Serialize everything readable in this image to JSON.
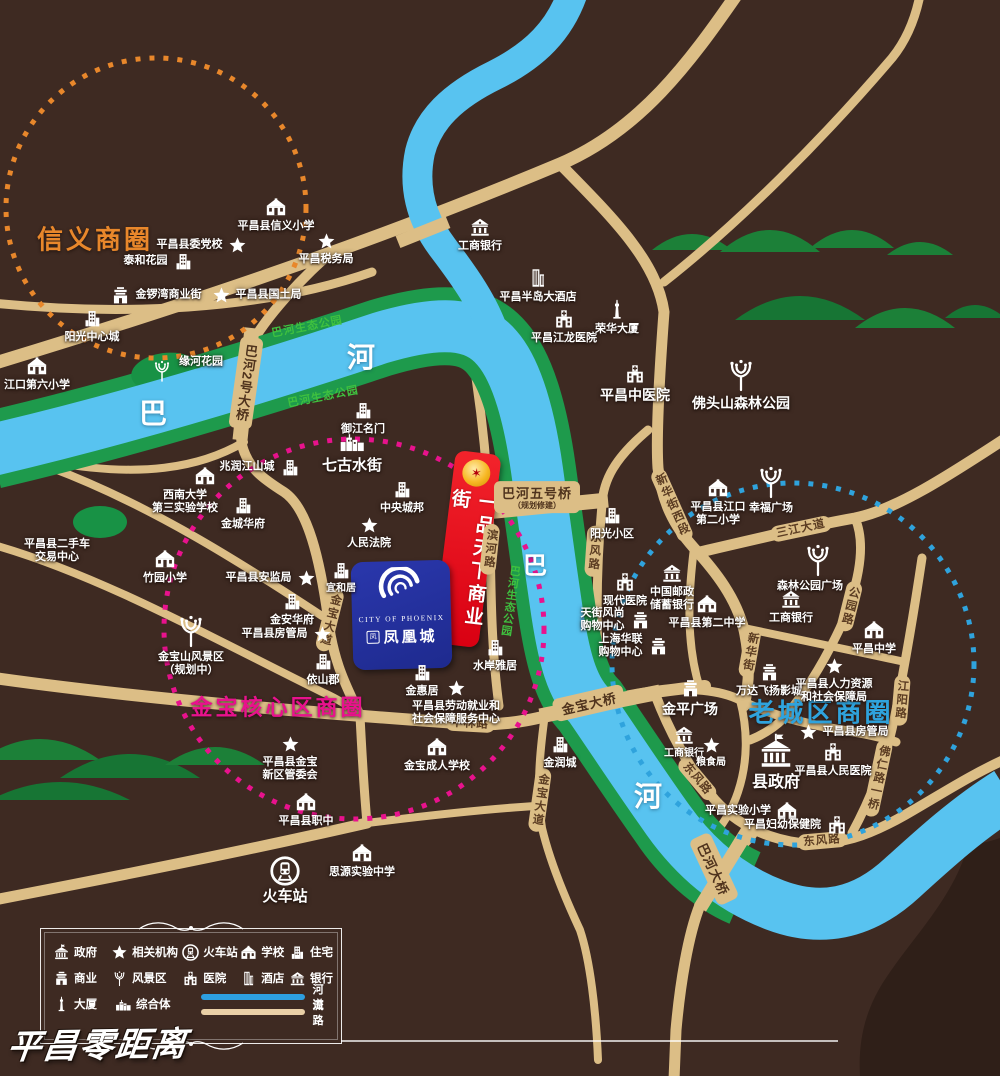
{
  "watermark": "平昌零距离",
  "zones": [
    {
      "label": "信义商圈",
      "color": "#E8872B",
      "cx": 156,
      "cy": 208,
      "r": 150,
      "lx": 95,
      "ly": 238,
      "fs": 26
    },
    {
      "label": "金宝核心区商圈",
      "color": "#E8128D",
      "cx": 354,
      "cy": 629,
      "r": 190,
      "lx": 278,
      "ly": 706,
      "fs": 22
    },
    {
      "label": "老城区商圈",
      "color": "#2FA3DD",
      "cx": 793,
      "cy": 664,
      "r": 181,
      "lx": 821,
      "ly": 711,
      "fs": 26
    }
  ],
  "river_labels": [
    {
      "t": "巴",
      "x": 153,
      "y": 412,
      "fs": 28
    },
    {
      "t": "河",
      "x": 361,
      "y": 356,
      "fs": 28
    },
    {
      "t": "巴",
      "x": 535,
      "y": 563,
      "fs": 24
    },
    {
      "t": "河",
      "x": 648,
      "y": 795,
      "fs": 28
    }
  ],
  "park_labels": [
    {
      "t": "巴河生态公园",
      "x": 307,
      "y": 326,
      "rot": -11
    },
    {
      "t": "巴河生态公园",
      "x": 323,
      "y": 396,
      "rot": -11
    },
    {
      "t": "巴河生态公园",
      "x": 510,
      "y": 601,
      "vert": 1,
      "rot": 8
    }
  ],
  "bridge_labels": [
    {
      "t": "巴河2号大桥",
      "x": 246,
      "y": 383,
      "vert": 1,
      "rot": 8
    },
    {
      "t": "巴河五号桥",
      "sub": "（规划修建）",
      "x": 537,
      "y": 497,
      "rot": 0
    },
    {
      "t": "金宝大桥",
      "x": 589,
      "y": 703,
      "rot": -13
    },
    {
      "t": "巴河大桥",
      "x": 714,
      "y": 869,
      "rot": 65
    }
  ],
  "road_labels": [
    {
      "t": "滨河路",
      "x": 490,
      "y": 549,
      "vert": 1,
      "rot": 6
    },
    {
      "t": "东风路",
      "x": 594,
      "y": 551,
      "vert": 1,
      "rot": 4
    },
    {
      "t": "东风路",
      "x": 697,
      "y": 779,
      "rot": 50
    },
    {
      "t": "东风路",
      "x": 822,
      "y": 841,
      "rot": -5
    },
    {
      "t": "新华街西段",
      "x": 672,
      "y": 505,
      "vert": 1,
      "rot": -24
    },
    {
      "t": "三江大道",
      "x": 801,
      "y": 529,
      "rot": -12
    },
    {
      "t": "公园路",
      "x": 850,
      "y": 606,
      "vert": 1,
      "rot": 14
    },
    {
      "t": "新华街",
      "x": 750,
      "y": 652,
      "vert": 1,
      "rot": 10
    },
    {
      "t": "江阳路",
      "x": 901,
      "y": 700,
      "vert": 1,
      "rot": 5
    },
    {
      "t": "佛仁路一桥",
      "x": 878,
      "y": 778,
      "vert": 1,
      "rot": 12
    },
    {
      "t": "金宝大道",
      "x": 330,
      "y": 620,
      "vert": 1,
      "rot": 14
    },
    {
      "t": "金宝大道",
      "x": 540,
      "y": 800,
      "vert": 1,
      "rot": 8
    },
    {
      "t": "中林路",
      "x": 470,
      "y": 724,
      "rot": 3
    }
  ],
  "pois": [
    {
      "t": "school",
      "x": 276,
      "y": 207,
      "lp": "b",
      "l": [
        "平昌县信义小学"
      ]
    },
    {
      "t": "star",
      "x": 237,
      "y": 245,
      "lp": "l",
      "l": [
        "平昌县委党校"
      ]
    },
    {
      "t": "star",
      "x": 326,
      "y": 241,
      "lp": "b",
      "l": [
        "平昌税务局"
      ]
    },
    {
      "t": "residence",
      "x": 183,
      "y": 261,
      "lp": "l",
      "l": [
        "泰和花园"
      ]
    },
    {
      "t": "commerce",
      "x": 120,
      "y": 295,
      "lp": "r",
      "l": [
        "金锣湾商业街"
      ]
    },
    {
      "t": "star",
      "x": 221,
      "y": 295,
      "lp": "r",
      "l": [
        "平昌县国土局"
      ]
    },
    {
      "t": "residence",
      "x": 92,
      "y": 318,
      "lp": "b",
      "l": [
        "阳光中心城"
      ]
    },
    {
      "t": "school",
      "x": 37,
      "y": 366,
      "lp": "b",
      "l": [
        "江口第六小学"
      ]
    },
    {
      "t": "bank",
      "x": 480,
      "y": 227,
      "lp": "b",
      "l": [
        "工商银行"
      ]
    },
    {
      "t": "hotel",
      "x": 538,
      "y": 278,
      "lp": "b",
      "l": [
        "平昌半岛大酒店"
      ]
    },
    {
      "t": "hospital",
      "x": 564,
      "y": 319,
      "lp": "b",
      "l": [
        "平昌江龙医院"
      ]
    },
    {
      "t": "tower",
      "x": 617,
      "y": 310,
      "lp": "b",
      "l": [
        "荣华大厦"
      ]
    },
    {
      "t": "hospital",
      "x": 635,
      "y": 374,
      "lp": "b",
      "l": [
        "平昌中医院"
      ],
      "fs": 14
    },
    {
      "t": "tree",
      "x": 741,
      "y": 375,
      "lp": "b",
      "l": [
        "佛头山森林公园"
      ],
      "fs": 14,
      "big": 1
    },
    {
      "t": "tree",
      "x": 162,
      "y": 371,
      "lp": "r",
      "l": [
        "缘河花园"
      ],
      "dy": -9
    },
    {
      "t": "residence",
      "x": 363,
      "y": 410,
      "lp": "b",
      "l": [
        "御江名门"
      ]
    },
    {
      "t": "complex",
      "x": 352,
      "y": 441,
      "lp": "b",
      "l": [
        "七古水街"
      ],
      "fs": 15
    },
    {
      "t": "residence",
      "x": 290,
      "y": 467,
      "lp": "l",
      "l": [
        "兆润江山城"
      ]
    },
    {
      "t": "school",
      "x": 205,
      "y": 476,
      "lp": "b",
      "l": [
        "西南大学",
        "第三实验学校"
      ],
      "dx": -20
    },
    {
      "t": "none",
      "x": 57,
      "y": 551,
      "lp": "c",
      "l": [
        "平昌县二手车",
        "交易中心"
      ]
    },
    {
      "t": "residence",
      "x": 243,
      "y": 505,
      "lp": "b",
      "l": [
        "金城华府"
      ]
    },
    {
      "t": "residence",
      "x": 402,
      "y": 489,
      "lp": "b",
      "l": [
        "中央城邦"
      ]
    },
    {
      "t": "star",
      "x": 369,
      "y": 525,
      "lp": "b",
      "l": [
        "人民法院"
      ]
    },
    {
      "t": "school",
      "x": 165,
      "y": 559,
      "lp": "b",
      "l": [
        "竹园小学"
      ]
    },
    {
      "t": "star",
      "x": 306,
      "y": 578,
      "lp": "l",
      "l": [
        "平昌县安监局"
      ]
    },
    {
      "t": "residence",
      "x": 341,
      "y": 570,
      "lp": "b",
      "l": [
        "宜和居"
      ],
      "fs": 10
    },
    {
      "t": "residence",
      "x": 292,
      "y": 601,
      "lp": "b",
      "l": [
        "金安华府"
      ]
    },
    {
      "t": "star",
      "x": 322,
      "y": 634,
      "lp": "l",
      "l": [
        "平昌县房管局"
      ]
    },
    {
      "t": "residence",
      "x": 323,
      "y": 661,
      "lp": "b",
      "l": [
        "依山郡"
      ]
    },
    {
      "t": "tree",
      "x": 191,
      "y": 631,
      "lp": "b",
      "l": [
        "金宝山风景区",
        "（规划中）"
      ],
      "big": 1
    },
    {
      "t": "residence",
      "x": 612,
      "y": 515,
      "lp": "b",
      "l": [
        "阳光小区"
      ]
    },
    {
      "t": "hospital",
      "x": 625,
      "y": 582,
      "lp": "b",
      "l": [
        "现代医院"
      ]
    },
    {
      "t": "bank",
      "x": 672,
      "y": 573,
      "lp": "b",
      "l": [
        "中国邮政",
        "储蓄银行"
      ]
    },
    {
      "t": "school",
      "x": 707,
      "y": 604,
      "lp": "b",
      "l": [
        "平昌县第二中学"
      ]
    },
    {
      "t": "commerce",
      "x": 640,
      "y": 620,
      "lp": "l",
      "l": [
        "天街风尚",
        "购物中心"
      ]
    },
    {
      "t": "commerce",
      "x": 658,
      "y": 646,
      "lp": "l",
      "l": [
        "上海华联",
        "购物中心"
      ]
    },
    {
      "t": "school",
      "x": 718,
      "y": 488,
      "lp": "b",
      "l": [
        "平昌县江口",
        "第二小学"
      ]
    },
    {
      "t": "tree",
      "x": 771,
      "y": 482,
      "lp": "b",
      "l": [
        "幸福广场"
      ],
      "big": 1
    },
    {
      "t": "tree",
      "x": 818,
      "y": 560,
      "lp": "b",
      "l": [
        "森林公园广场"
      ],
      "big": 1,
      "dx": -8
    },
    {
      "t": "bank",
      "x": 791,
      "y": 599,
      "lp": "b",
      "l": [
        "工商银行"
      ]
    },
    {
      "t": "school",
      "x": 874,
      "y": 630,
      "lp": "b",
      "l": [
        "平昌中学"
      ]
    },
    {
      "t": "commerce",
      "x": 769,
      "y": 672,
      "lp": "b",
      "l": [
        "万达飞扬影城"
      ]
    },
    {
      "t": "star",
      "x": 834,
      "y": 666,
      "lp": "b",
      "l": [
        "平昌县人力资源",
        "和社会保障局"
      ]
    },
    {
      "t": "commerce",
      "x": 690,
      "y": 688,
      "lp": "b",
      "l": [
        "金平广场"
      ],
      "fs": 14
    },
    {
      "t": "star",
      "x": 808,
      "y": 732,
      "lp": "r",
      "l": [
        "平昌县房管局"
      ]
    },
    {
      "t": "bank",
      "x": 684,
      "y": 735,
      "lp": "b",
      "l": [
        "工商银行"
      ],
      "fs": 10
    },
    {
      "t": "star",
      "x": 711,
      "y": 745,
      "lp": "b",
      "l": [
        "粮食局"
      ],
      "fs": 10
    },
    {
      "t": "government",
      "x": 776,
      "y": 752,
      "lp": "b",
      "l": [
        "县政府"
      ],
      "fs": 16,
      "big": 1
    },
    {
      "t": "hospital",
      "x": 833,
      "y": 752,
      "lp": "b",
      "l": [
        "平昌县人民医院"
      ]
    },
    {
      "t": "school",
      "x": 787,
      "y": 811,
      "lp": "l",
      "l": [
        "平昌实验小学"
      ]
    },
    {
      "t": "hospital",
      "x": 837,
      "y": 825,
      "lp": "l",
      "l": [
        "平昌妇幼保健院"
      ]
    },
    {
      "t": "residence",
      "x": 495,
      "y": 647,
      "lp": "b",
      "l": [
        "水岸雅居"
      ]
    },
    {
      "t": "residence",
      "x": 422,
      "y": 672,
      "lp": "b",
      "l": [
        "金惠居"
      ]
    },
    {
      "t": "star",
      "x": 456,
      "y": 688,
      "lp": "b",
      "l": [
        "平昌县劳动就业和",
        "社会保障服务中心"
      ]
    },
    {
      "t": "school",
      "x": 437,
      "y": 747,
      "lp": "b",
      "l": [
        "金宝成人学校"
      ]
    },
    {
      "t": "residence",
      "x": 560,
      "y": 744,
      "lp": "b",
      "l": [
        "金润城"
      ]
    },
    {
      "t": "star",
      "x": 290,
      "y": 744,
      "lp": "b",
      "l": [
        "平昌县金宝",
        "新区管委会"
      ]
    },
    {
      "t": "school",
      "x": 306,
      "y": 802,
      "lp": "b",
      "l": [
        "平昌县职中"
      ]
    },
    {
      "t": "school",
      "x": 362,
      "y": 853,
      "lp": "b",
      "l": [
        "思源实验中学"
      ]
    },
    {
      "t": "train",
      "x": 285,
      "y": 871,
      "lp": "b",
      "l": [
        "火车站"
      ],
      "fs": 15
    }
  ],
  "landmarks": {
    "red": {
      "text": "一品天下商业街",
      "emblem": "✶"
    },
    "blue": {
      "en": "CITY OF PHOENIX",
      "seal": "凤",
      "cn": "凤凰城"
    }
  },
  "legend": {
    "rows": [
      [
        {
          "icon": "government",
          "label": "政府"
        },
        {
          "icon": "star",
          "label": "相关机构"
        },
        {
          "icon": "train",
          "label": "火车站"
        },
        {
          "icon": "school",
          "label": "学校"
        },
        {
          "icon": "residence",
          "label": "住宅"
        }
      ],
      [
        {
          "icon": "commerce",
          "label": "商业"
        },
        {
          "icon": "tree",
          "label": "风景区"
        },
        {
          "icon": "hospital",
          "label": "医院"
        },
        {
          "icon": "hotel",
          "label": "酒店"
        },
        {
          "icon": "bank",
          "label": "银行"
        }
      ],
      [
        {
          "icon": "tower",
          "label": "大厦"
        },
        {
          "icon": "complex",
          "label": "综合体"
        }
      ]
    ],
    "river_label": "河流",
    "road_label": "道路",
    "river_color": "#2D9FE0",
    "road_color": "#E9CFA6"
  }
}
